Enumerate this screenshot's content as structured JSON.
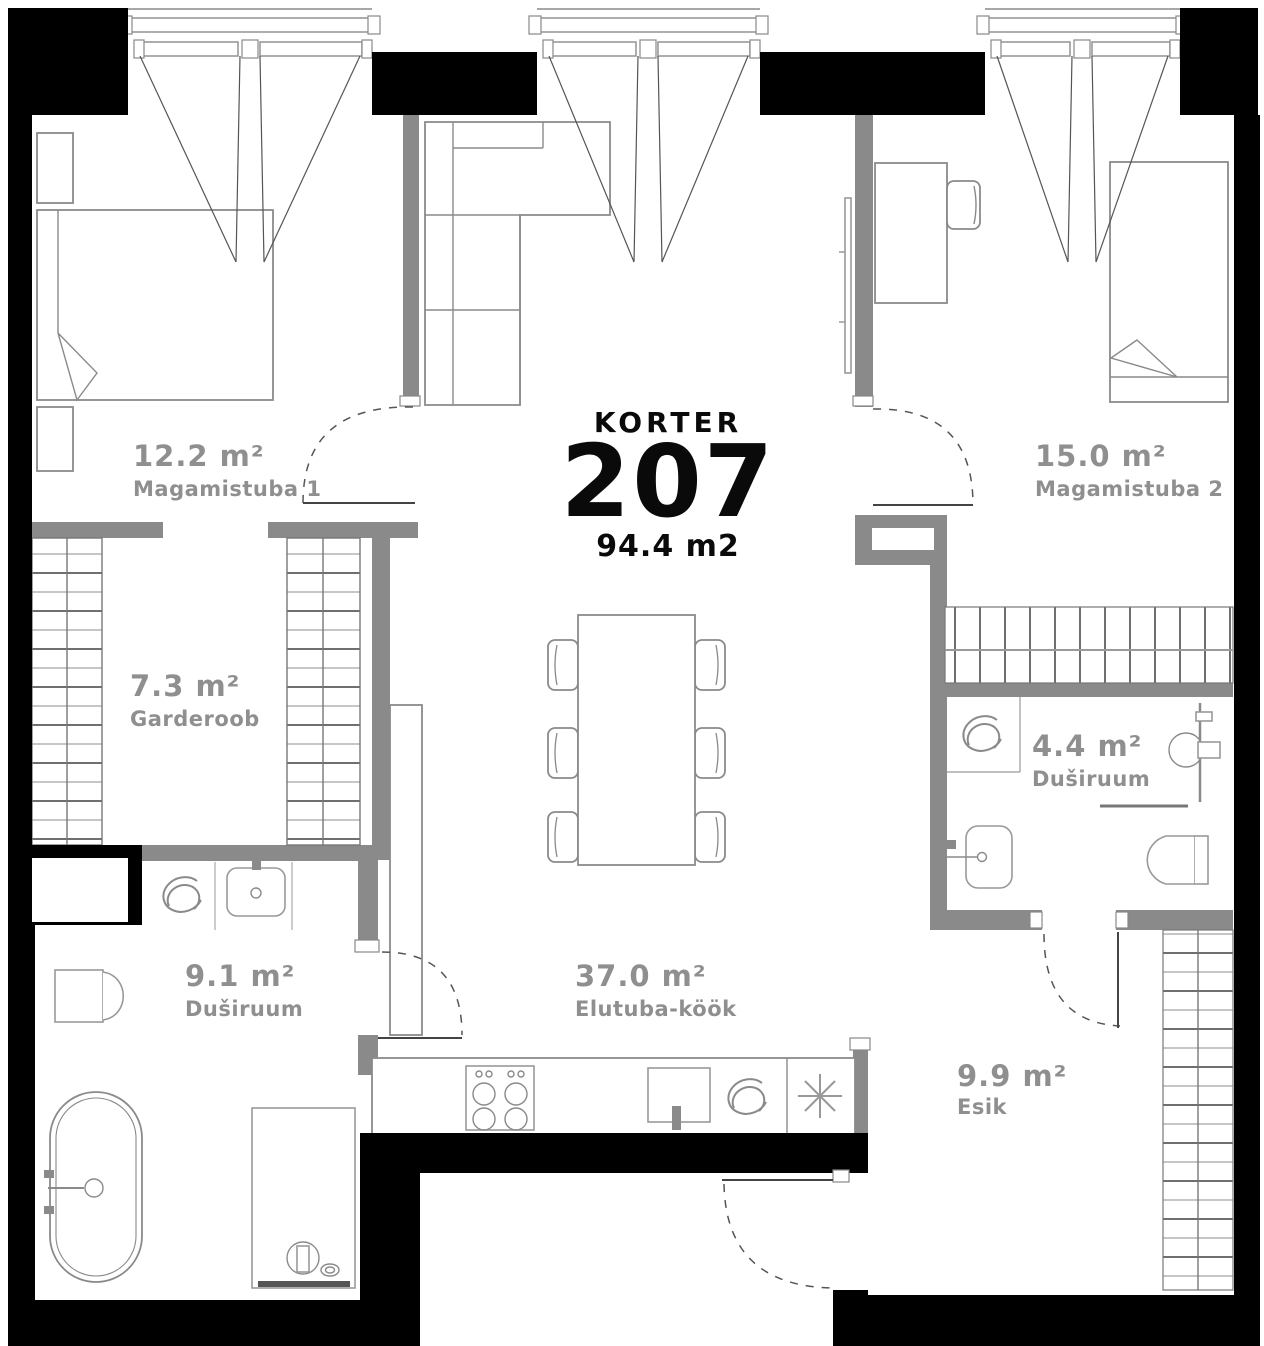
{
  "title": {
    "label": "KORTER",
    "number": "207",
    "area": "94.4 m2"
  },
  "rooms": {
    "magamistuba1": {
      "area": "12.2 m²",
      "name": "Magamistuba 1"
    },
    "garderoob": {
      "area": "7.3 m²",
      "name": "Garderoob"
    },
    "dushiruum1": {
      "area": "9.1 m²",
      "name": "Duširuum"
    },
    "elutuba_kook": {
      "area": "37.0 m²",
      "name": "Elutuba-köök"
    },
    "magamistuba2": {
      "area": "15.0 m²",
      "name": "Magamistuba 2"
    },
    "dushiruum2": {
      "area": "4.4 m²",
      "name": "Duširuum"
    },
    "esik": {
      "area": "9.9 m²",
      "name": "Esik"
    }
  },
  "colors": {
    "exterior_wall": "#000000",
    "interior_wall": "#8a8a8a",
    "furniture_line": "#8a8a8a",
    "room_label": "#8f8f8f",
    "title_text": "#0a0a0a"
  }
}
